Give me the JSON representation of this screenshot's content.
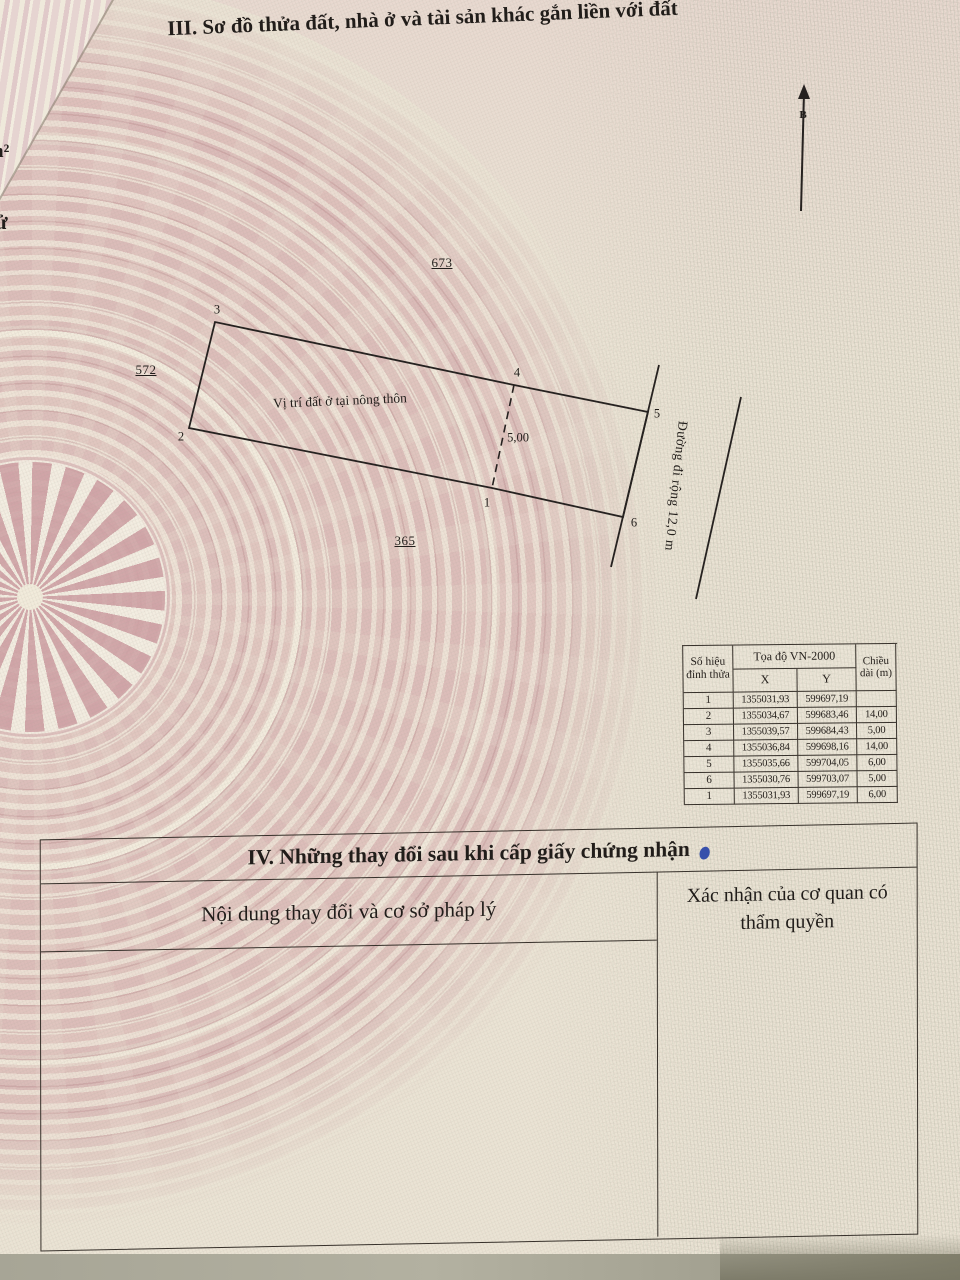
{
  "page": {
    "section3_title": "III. Sơ đồ thửa đất, nhà ở và tài sản khác gắn liền với đất",
    "left_fragments": {
      "top": "n²",
      "bottom": "ử"
    }
  },
  "diagram": {
    "north_label": "B",
    "site_label": "Vị trí đất ở tại nông thôn",
    "dimension_label": "5,00",
    "road_label": "Đường đi rộng 12,0 m",
    "parcels": {
      "top": "673",
      "left": "572",
      "bottom": "365"
    },
    "vertices": {
      "v1": "1",
      "v2": "2",
      "v3": "3",
      "v4": "4",
      "v5": "5",
      "v6": "6"
    }
  },
  "coord_table": {
    "headers": {
      "corner": "Số hiệu đỉnh thửa",
      "coords": "Tọa độ VN-2000",
      "x": "X",
      "y": "Y",
      "length": "Chiều dài (m)"
    },
    "rows": [
      {
        "id": "1",
        "x": "1355031,93",
        "y": "599697,19",
        "len": ""
      },
      {
        "id": "2",
        "x": "1355034,67",
        "y": "599683,46",
        "len": "14,00"
      },
      {
        "id": "3",
        "x": "1355039,57",
        "y": "599684,43",
        "len": "5,00"
      },
      {
        "id": "4",
        "x": "1355036,84",
        "y": "599698,16",
        "len": "14,00"
      },
      {
        "id": "5",
        "x": "1355035,66",
        "y": "599704,05",
        "len": "6,00"
      },
      {
        "id": "6",
        "x": "1355030,76",
        "y": "599703,07",
        "len": "5,00"
      },
      {
        "id": "1",
        "x": "1355031,93",
        "y": "599697,19",
        "len": "6,00"
      }
    ]
  },
  "section4": {
    "title": "IV. Những thay đổi sau khi cấp giấy chứng nhận",
    "col_left": "Nội dung thay đổi và cơ sở pháp lý",
    "col_right": "Xác nhận của cơ quan có thẩm quyền"
  },
  "colors": {
    "ink_blue": "#2843a8",
    "line": "#2a2420"
  }
}
